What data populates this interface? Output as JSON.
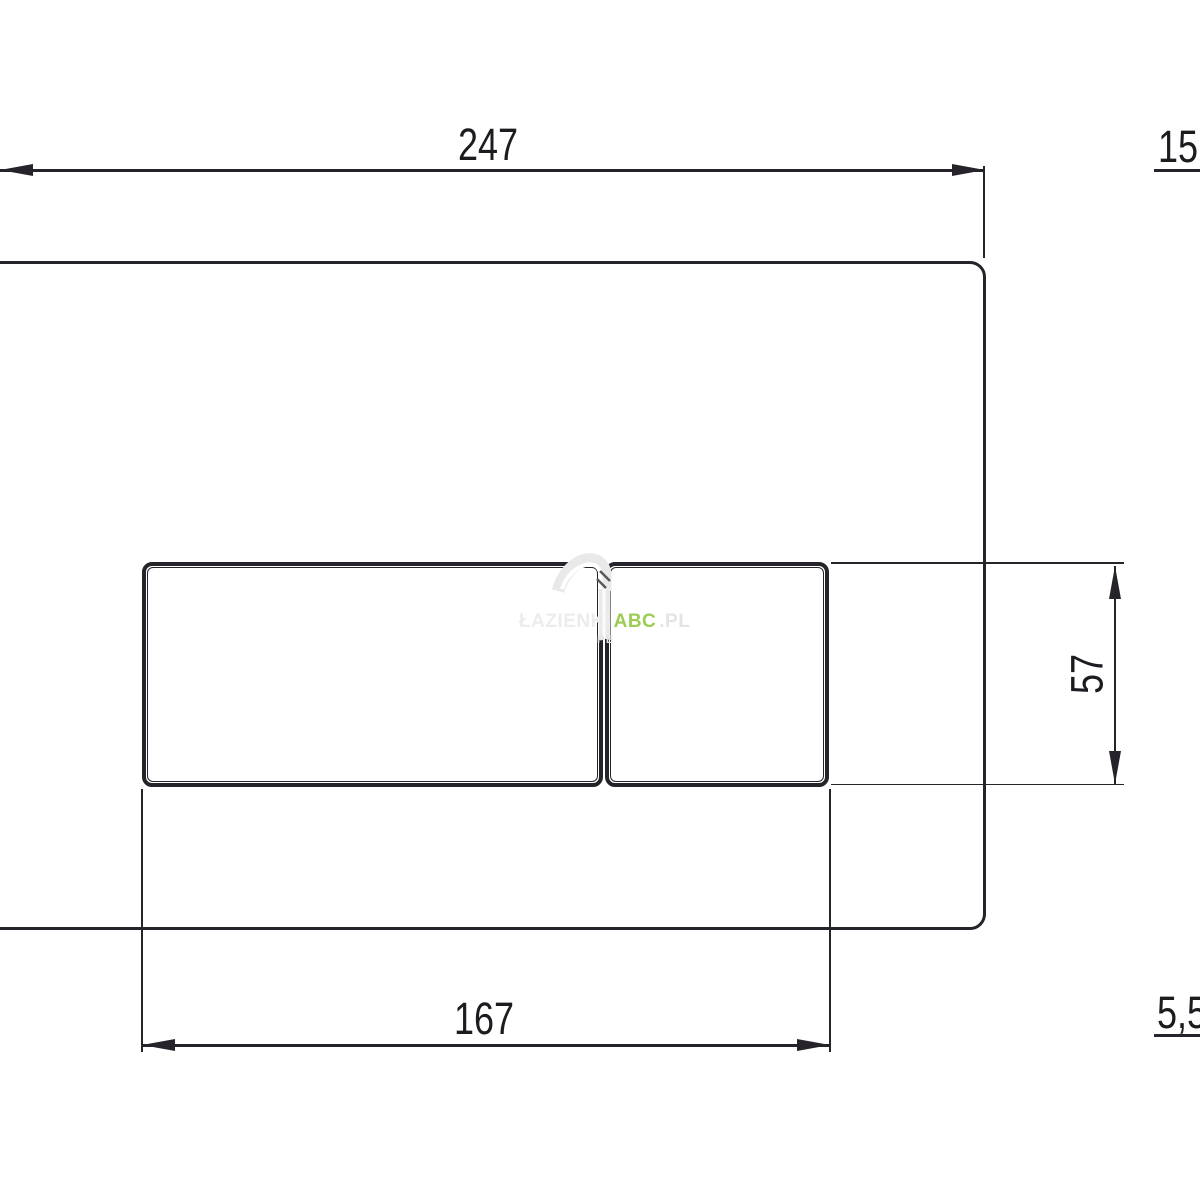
{
  "drawing": {
    "dimensions": {
      "plate_width": "247",
      "plate_depth": "15",
      "button_height": "57",
      "buttons_width": "167",
      "button_depth": "5,5"
    },
    "watermark": {
      "brand_prefix": "ŁAZIENKI",
      "brand_accent": "ABC",
      "brand_suffix": ".PL",
      "tagline": "PE"
    },
    "colors": {
      "line": "#27232a",
      "text": "#1b1b20",
      "accent_green": "#9ccc52",
      "watermark_gray": "#e9e9e9"
    }
  }
}
